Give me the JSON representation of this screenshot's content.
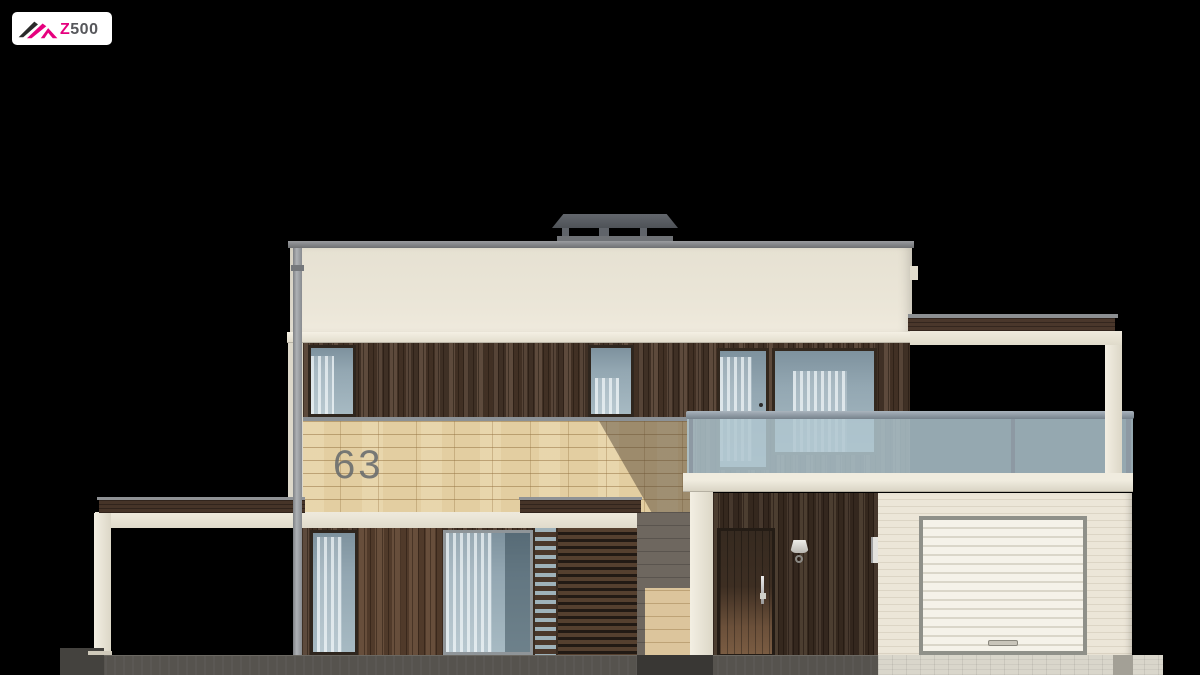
{
  "logo": {
    "z": "Z",
    "number": "500"
  },
  "house": {
    "number": "63"
  },
  "palette": {
    "background": "#000000",
    "brand_pink": "#e6007e",
    "brand_gray": "#56575b",
    "wall_cream": "#e9e4d6",
    "wood_dark": "#4b3a2e",
    "stone_sand": "#e3cea1",
    "glass_blue": "#a9bcc4",
    "roof_gray": "#83868a",
    "ground_gray": "#56534e",
    "driveway": "#d9d6cb"
  }
}
